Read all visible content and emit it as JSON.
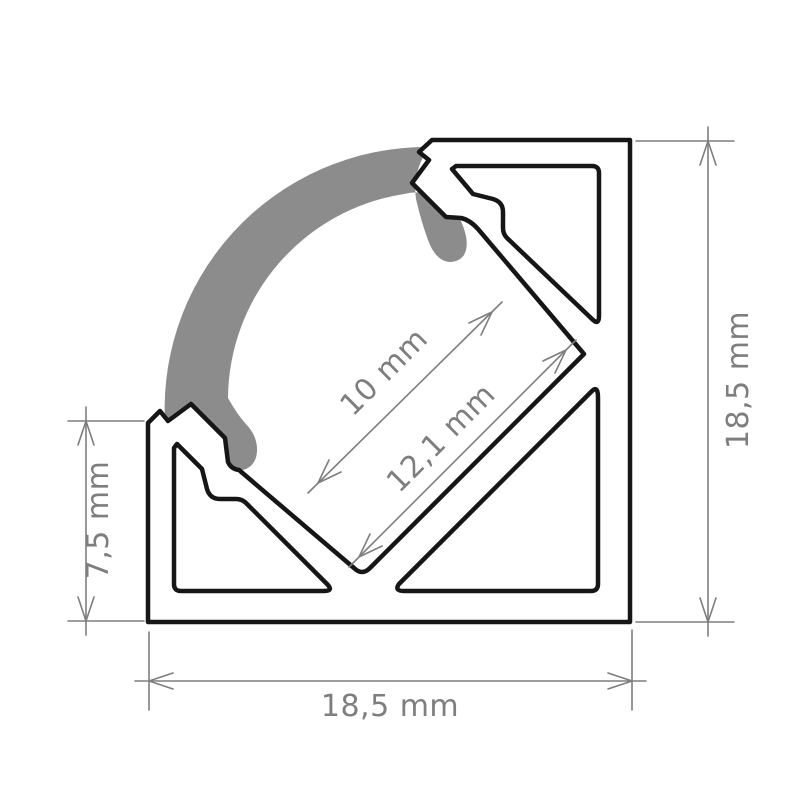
{
  "colors": {
    "background": "#ffffff",
    "body_fill": "#ffffff",
    "outline": "#161616",
    "lens": "#8c8c8c",
    "dimension": "#7e7e7e"
  },
  "diagram": {
    "kind": "cross-section technical drawing of a 45-degree corner LED aluminium profile with diffuser cover",
    "labels": {
      "height_right": "18,5 mm",
      "width_bottom": "18,5 mm",
      "height_left": "7,5 mm",
      "aperture": "10 mm",
      "channel": "12,1 mm"
    }
  }
}
